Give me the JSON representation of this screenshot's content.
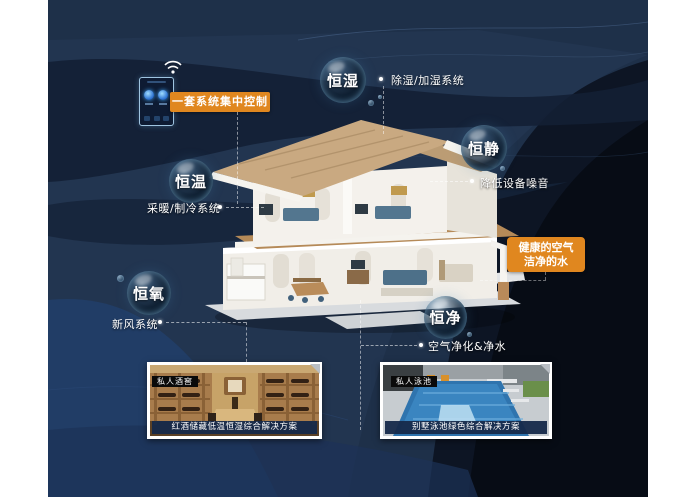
{
  "colors": {
    "accent_orange": "#E0871F",
    "panel_navy": "#22344F",
    "panel_dark": "#0B1322",
    "caption_band": "#16294A",
    "bubble_text": "#FFFFFF"
  },
  "icons": {
    "wifi": "wifi-icon",
    "phone": "smart-控制-panel-icon",
    "corner_fold": "corner-fold-icon"
  },
  "control_label": {
    "text": "一套系统集中控制"
  },
  "bubbles": [
    {
      "name": "恒湿",
      "desc": "除湿/加湿系统"
    },
    {
      "name": "恒静",
      "desc": "降低设备噪音"
    },
    {
      "name": "恒温",
      "desc": "采暖/制冷系统"
    },
    {
      "name": "恒氧",
      "desc": "新风系统"
    },
    {
      "name": "恒净",
      "desc": "空气净化&净水"
    }
  ],
  "highlight": {
    "line1": "健康的空气",
    "line2": "洁净的水"
  },
  "cards": [
    {
      "tag": "私人酒窖",
      "caption": "红酒储藏低温恒湿综合解决方案"
    },
    {
      "tag": "私人泳池",
      "caption": "别墅泳池绿色综合解决方案"
    }
  ]
}
